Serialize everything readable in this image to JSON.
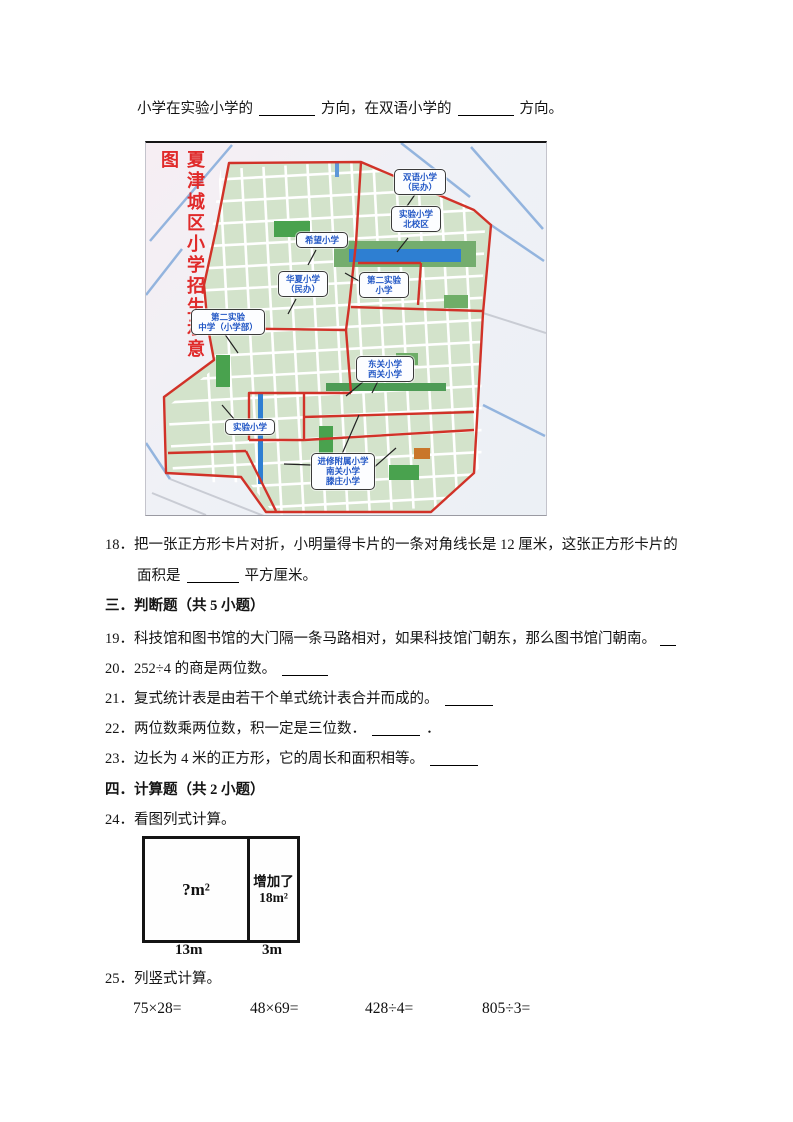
{
  "intro": {
    "part1": "小学在实验小学的",
    "part2": "方向，在双语小学的",
    "part3": "方向。"
  },
  "map": {
    "title": "夏津城区小学招生示意图",
    "labels": [
      {
        "id": "shuangyu",
        "text": "双语小学\n（民办）"
      },
      {
        "id": "shiyan-north",
        "text": "实验小学\n北校区"
      },
      {
        "id": "xiwang",
        "text": "希望小学"
      },
      {
        "id": "huaxia",
        "text": "华夏小学\n（民办）"
      },
      {
        "id": "dier-shiyan-xiaoxue",
        "text": "第二实验\n小学"
      },
      {
        "id": "dier-shiyan-zhongxue",
        "text": "第二实验\n中学（小学部）"
      },
      {
        "id": "dongguan-xiguan",
        "text": "东关小学\n西关小学"
      },
      {
        "id": "shiyan",
        "text": "实验小学"
      },
      {
        "id": "jinxiu-nanguan",
        "text": "进修附属小学\n南关小学\n滕庄小学"
      }
    ],
    "colors": {
      "boundary": "#d13228",
      "city_green": "#d3e3cb",
      "water_blue": "#2e7fd2",
      "label_blue": "#2257c5",
      "title_red": "#e02a2a"
    }
  },
  "q18": {
    "line1": "18．把一张正方形卡片对折，小明量得卡片的一条对角线长是 12 厘米，这张正方形卡片的",
    "line2_pre": "面积是",
    "line2_post": "平方厘米。"
  },
  "section3": "三．判断题（共 5 小题）",
  "q19": {
    "text": "19．科技馆和图书馆的大门隔一条马路相对，如果科技馆门朝东，那么图书馆门朝南。"
  },
  "q20": {
    "text": "20．252÷4 的商是两位数。"
  },
  "q21": {
    "text": "21．复式统计表是由若干个单式统计表合并而成的。"
  },
  "q22": {
    "text": "22．两位数乘两位数，积一定是三位数．",
    "suffix": "．"
  },
  "q23": {
    "text": "23．边长为 4 米的正方形，它的周长和面积相等。"
  },
  "section4": "四．计算题（共 2 小题）",
  "q24": {
    "text": "24．看图列式计算。"
  },
  "diagram": {
    "left_area": "?m²",
    "right_line1": "增加了",
    "right_line2": "18m²",
    "width_left": "13m",
    "width_right": "3m"
  },
  "q25": {
    "text": "25．列竖式计算。"
  },
  "calculations": [
    "75×28=",
    "48×69=",
    "428÷4=",
    "805÷3="
  ]
}
